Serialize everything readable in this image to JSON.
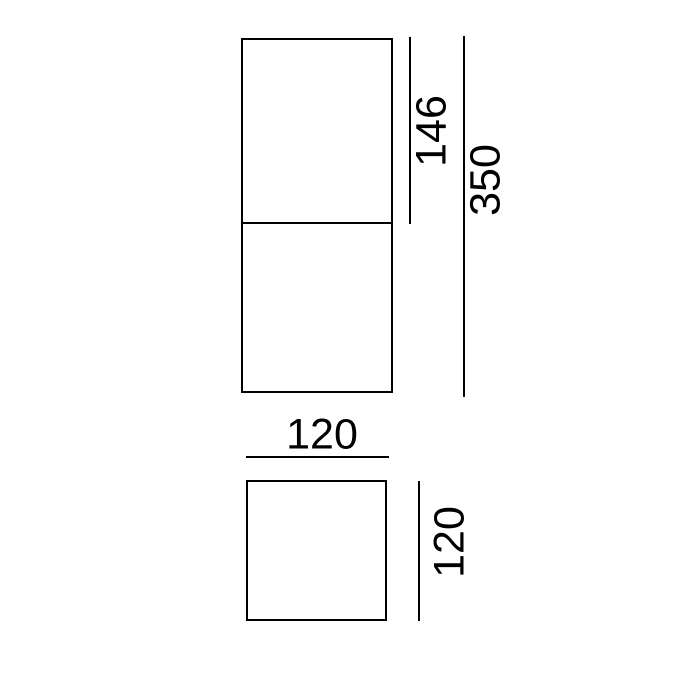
{
  "drawing": {
    "background_color": "#ffffff",
    "line_color": "#000000",
    "views": {
      "front": {
        "upper_section_height": "146",
        "total_height": "350"
      },
      "top": {
        "width": "120",
        "depth": "120"
      }
    }
  }
}
